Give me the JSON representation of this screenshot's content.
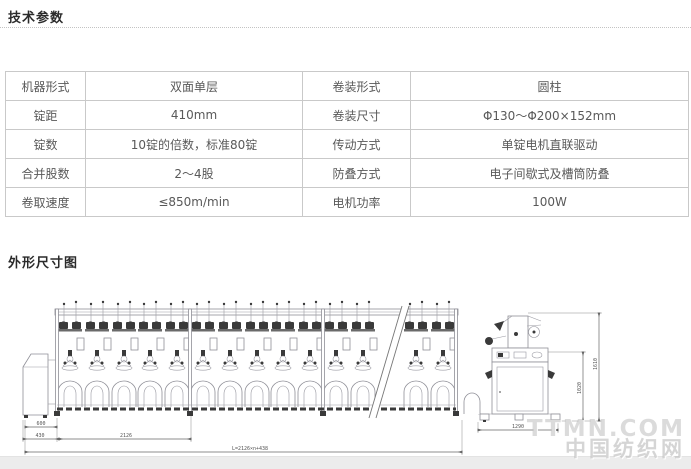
{
  "page": {
    "background": "#ffffff",
    "footer_strip_color": "#ececec"
  },
  "sections": {
    "tech_params_title": "技术参数",
    "dimensions_title": "外形尺寸图"
  },
  "spec_table": {
    "rows": [
      [
        "机器形式",
        "双面单层",
        "卷装形式",
        "圆柱"
      ],
      [
        "锭距",
        "410mm",
        "卷装尺寸",
        "Φ130～Φ200×152mm"
      ],
      [
        "锭数",
        "10锭的倍数，标准80锭",
        "传动方式",
        "单锭电机直联驱动"
      ],
      [
        "合并股数",
        "2～4股",
        "防叠方式",
        "电子间歇式及槽筒防叠"
      ],
      [
        "卷取速度",
        "≤850m/min",
        "电机功率",
        "100W"
      ]
    ]
  },
  "diagram": {
    "dims": {
      "left_top": "600",
      "left_bottom": "430",
      "section_width": "2126",
      "overall_length": "L=2126×n+438",
      "side_width": "1290",
      "side_height_inner": "1020",
      "side_height_outer": "1610"
    }
  },
  "watermark": {
    "line1": "TTMN.COM",
    "line2": "中国纺织网"
  }
}
